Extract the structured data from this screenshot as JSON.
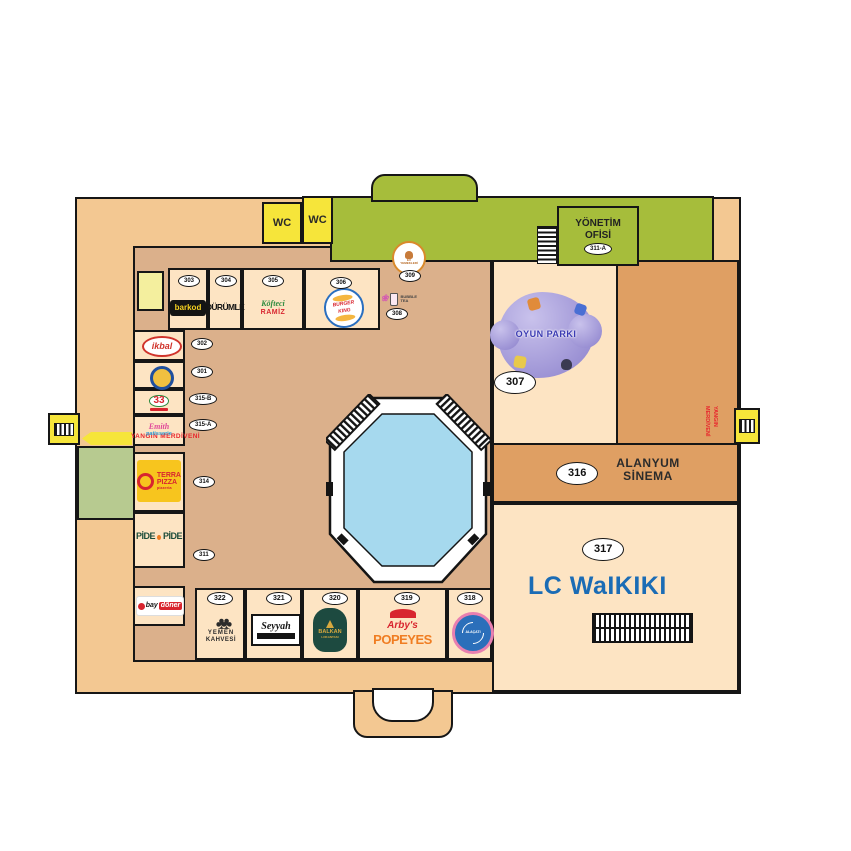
{
  "labels": {
    "wc": "WC",
    "yonetim_line1": "YÖNETİM",
    "yonetim_line2": "OFİSİ",
    "yonetim_unit": "311-A",
    "fire_exit_left": "YANGIN MERDİVENİ",
    "fire_exit_right": "YANGIN MERDİVENİ"
  },
  "stores": {
    "s303": {
      "unit": "303",
      "name": "barkod"
    },
    "s304": {
      "unit": "304",
      "name": "DÜRÜMLE"
    },
    "s305": {
      "unit": "305",
      "name_top": "Köfteci",
      "name_bottom": "RAMİZ"
    },
    "s306": {
      "unit": "306",
      "line1": "BURGER",
      "line2": "KING"
    },
    "s308": {
      "unit": "308",
      "line1": "BUBBLE",
      "line2": "TEA"
    },
    "s309": {
      "unit": "309",
      "line1": "EV",
      "line2": "YEMEKLERİ"
    },
    "s302": {
      "unit": "302",
      "name": "ikbal"
    },
    "s301": {
      "unit": "301"
    },
    "s315b": {
      "unit": "315-B",
      "name": "33"
    },
    "s315a": {
      "unit": "315-A",
      "script": "Emith",
      "line2": "patisserie"
    },
    "s314": {
      "unit": "314",
      "line1": "TERRA",
      "line2": "PIZZA",
      "line3": "pizzeria"
    },
    "s311": {
      "unit": "311",
      "left": "PİDE",
      "right": "PİDE"
    },
    "sbay": {
      "prefix": "bay",
      "suffix": "döner"
    },
    "s322": {
      "unit": "322",
      "line1": "YEMEN",
      "line2": "KAHVESİ"
    },
    "s321": {
      "unit": "321",
      "name": "Seyyah"
    },
    "s320": {
      "unit": "320",
      "line1": "BALKAN",
      "line2": "LOKANTASI"
    },
    "s319": {
      "unit": "319",
      "line1": "Arby's",
      "line2": "POPEYES"
    },
    "s318": {
      "unit": "318",
      "name": "ALAÇATI"
    },
    "s307": {
      "unit": "307",
      "name": "OYUN PARKI"
    },
    "s316": {
      "unit": "316",
      "line1": "ALANYUM",
      "line2": "SİNEMA"
    },
    "s317": {
      "unit": "317",
      "name": "LC WaIKIKI"
    }
  },
  "colors": {
    "outer": "#f3c892",
    "corridor": "#dbb08b",
    "cell": "#fde4c3",
    "green": "#a6bd3b",
    "yellow": "#f6e53a",
    "dark_orange": "#df9f63",
    "pale_yellow": "#f4ef9e",
    "left_green_room": "#b7ca90",
    "pool_blue": "#a6d9ee",
    "red_text": "#e8262d",
    "lcw_blue": "#1b6cb5"
  }
}
